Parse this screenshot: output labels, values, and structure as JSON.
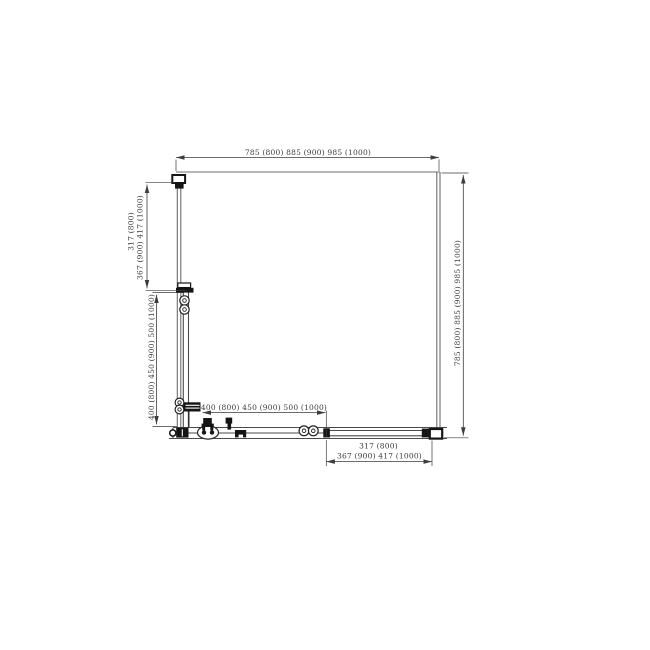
{
  "page": {
    "background": "#ffffff"
  },
  "drawing": {
    "name": "square-corner-shower-enclosure-plan",
    "line_color": "#3d3d3d",
    "glass_color": "#6f6f6f",
    "hardware_color": "#151515",
    "dims": {
      "top_width": "785 (800)  885 (900)  985 (1000)",
      "right_height": "785 (800)  885 (900)  985 (1000)",
      "left_upper_line1": "317 (800)",
      "left_upper_line2": "367 (900)  417 (1000)",
      "left_lower": "400 (800)  450 (900)  500 (1000)",
      "bottom_inner": "400 (800)  450 (900)  500 (1000)",
      "bottom_right_line1": "317 (800)",
      "bottom_right_line2": "367 (900)  417 (1000)"
    }
  }
}
